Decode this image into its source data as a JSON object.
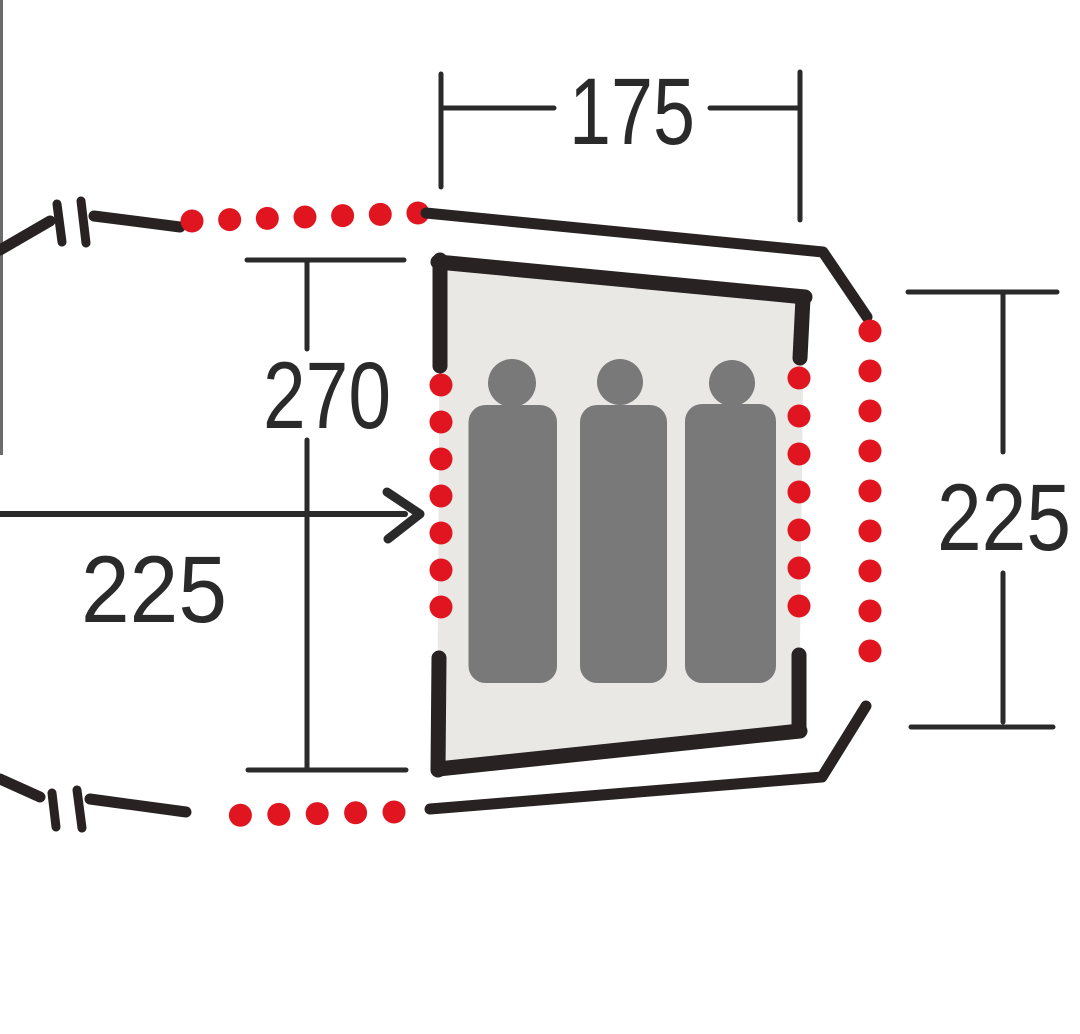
{
  "diagram": {
    "title": "Tent floor plan - sleeping cabin with three berths",
    "sleeper_count": 3
  },
  "labels": {
    "top_width": "175",
    "inner_depth": "270",
    "left_length": "225",
    "right_depth": "225"
  },
  "icons": {
    "sleeping_person": "sleeping-person-icon"
  },
  "colors": {
    "background": "#ffffff",
    "outline": "#282223",
    "dimension": "#2b2a2a",
    "accent_red": "#e0151f",
    "cabin_fill": "#eae8e4",
    "figure_gray": "#797979",
    "edge_artifact": "#6b6b6b"
  }
}
